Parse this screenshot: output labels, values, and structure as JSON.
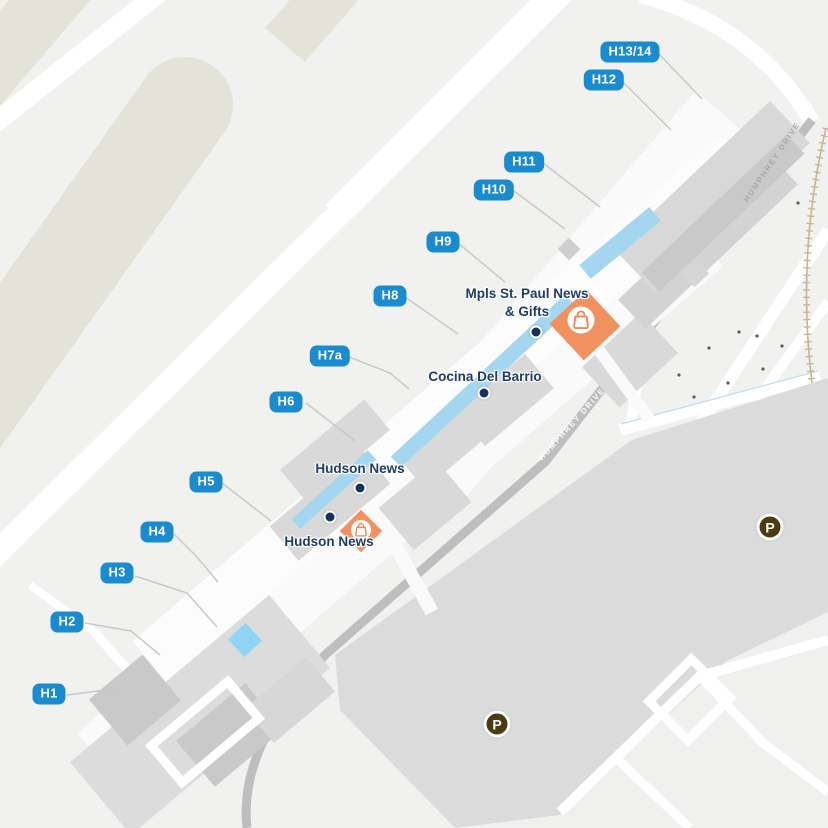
{
  "gates": [
    {
      "label": "H13/14"
    },
    {
      "label": "H12"
    },
    {
      "label": "H11"
    },
    {
      "label": "H10"
    },
    {
      "label": "H9"
    },
    {
      "label": "H8"
    },
    {
      "label": "H7a"
    },
    {
      "label": "H6"
    },
    {
      "label": "H5"
    },
    {
      "label": "H4"
    },
    {
      "label": "H3"
    },
    {
      "label": "H2"
    },
    {
      "label": "H1"
    }
  ],
  "pois": {
    "mpls": {
      "line1": "Mpls St. Paul News",
      "line2": "& Gifts"
    },
    "cocina": "Cocina Del Barrio",
    "hudson_upper": "Hudson News",
    "hudson_lower": "Hudson News"
  },
  "parking": {
    "label": "P"
  },
  "roads": {
    "humphrey_top": "HUMPHREY DRIVE",
    "humphrey_mid": "HUMPHREY DRIVE"
  },
  "icons": {
    "shop": "shopping-bag-icon",
    "parking": "parking-icon"
  },
  "colors": {
    "background": "#f1f1ef",
    "runway": "#e3e3d9",
    "building": "#d9d9d9",
    "building_dark": "#c9c9c9",
    "parking_structure": "#dbdbdb",
    "road_gray": "#bebebe",
    "concourse_blue": "#a4d7ef",
    "bright_blue": "#8fd4f2",
    "gate_pill_blue": "#1b8bd0",
    "poi_text_navy": "#1e3c64",
    "marker_dot_navy": "#14335c",
    "shop_orange": "#f0915f",
    "parking_brown": "#4a3c0f",
    "railroad_tan": "#c9b593"
  }
}
